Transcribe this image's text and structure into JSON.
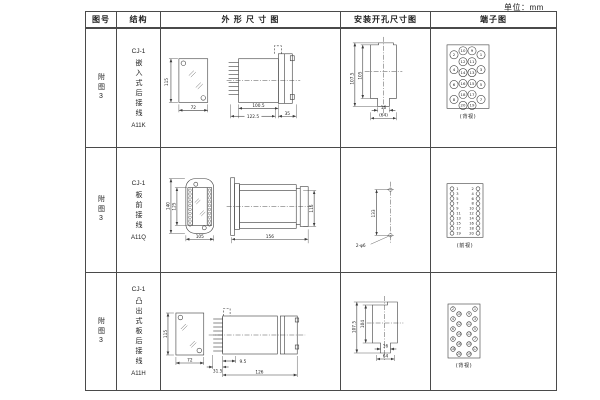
{
  "page": {
    "unit_label": "单位：mm"
  },
  "header": {
    "fig_no": "图号",
    "structure": "结构",
    "outline": "外 形 尺 寸 图",
    "mounting": "安装开孔尺寸图",
    "terminal": "端子图"
  },
  "rows": [
    {
      "fig_no": "附图3",
      "model": "CJ-1",
      "structure": "嵌入式后接线",
      "code": "A11K",
      "outline": {
        "h": "115",
        "w": "72",
        "depth1": "100.5",
        "depth2": "122.5",
        "flange": "35"
      },
      "mounting": {
        "h1": "107.5",
        "h2": "105",
        "slot_w": "16",
        "hole_span": "(64)"
      },
      "terminal": {
        "view": "(背视)",
        "outer_left": [
          "2",
          "4",
          "6",
          "8"
        ],
        "inner_left": [
          "10",
          "12",
          "14",
          "16",
          "18",
          "20"
        ],
        "inner_right": [
          "9",
          "11",
          "13",
          "15",
          "17",
          "19"
        ],
        "outer_right": [
          "1",
          "3",
          "5",
          "7"
        ]
      }
    },
    {
      "fig_no": "附图3",
      "model": "CJ-1",
      "structure": "板前接线",
      "code": "A11Q",
      "outline": {
        "h": "140",
        "h2": "125",
        "w": "105",
        "depth": "156",
        "body_h": "115"
      },
      "mounting": {
        "hole_span": "133",
        "holes": "2-φ6"
      },
      "terminal": {
        "view": "(前视)",
        "left": [
          "1",
          "3",
          "5",
          "7",
          "9",
          "11",
          "13",
          "15",
          "17",
          "19"
        ],
        "right": [
          "2",
          "4",
          "6",
          "8",
          "10",
          "12",
          "14",
          "16",
          "18",
          "20"
        ]
      }
    },
    {
      "fig_no": "附图3",
      "model": "CJ-1",
      "structure": "凸出式板后接线",
      "code": "A11H",
      "outline": {
        "h": "115",
        "w": "72",
        "stud": "31.5",
        "offset": "9.5",
        "depth": "126"
      },
      "mounting": {
        "h1": "107.5",
        "h2": "104",
        "slot_w": "16",
        "hole_span": "64"
      },
      "terminal": {
        "view": "(背视)",
        "left": [
          "2",
          "10",
          "4",
          "12",
          "6",
          "14",
          "8",
          "16",
          "18",
          "20"
        ],
        "right": [
          "1",
          "9",
          "3",
          "11",
          "5",
          "13",
          "7",
          "15",
          "17",
          "19"
        ]
      }
    }
  ]
}
